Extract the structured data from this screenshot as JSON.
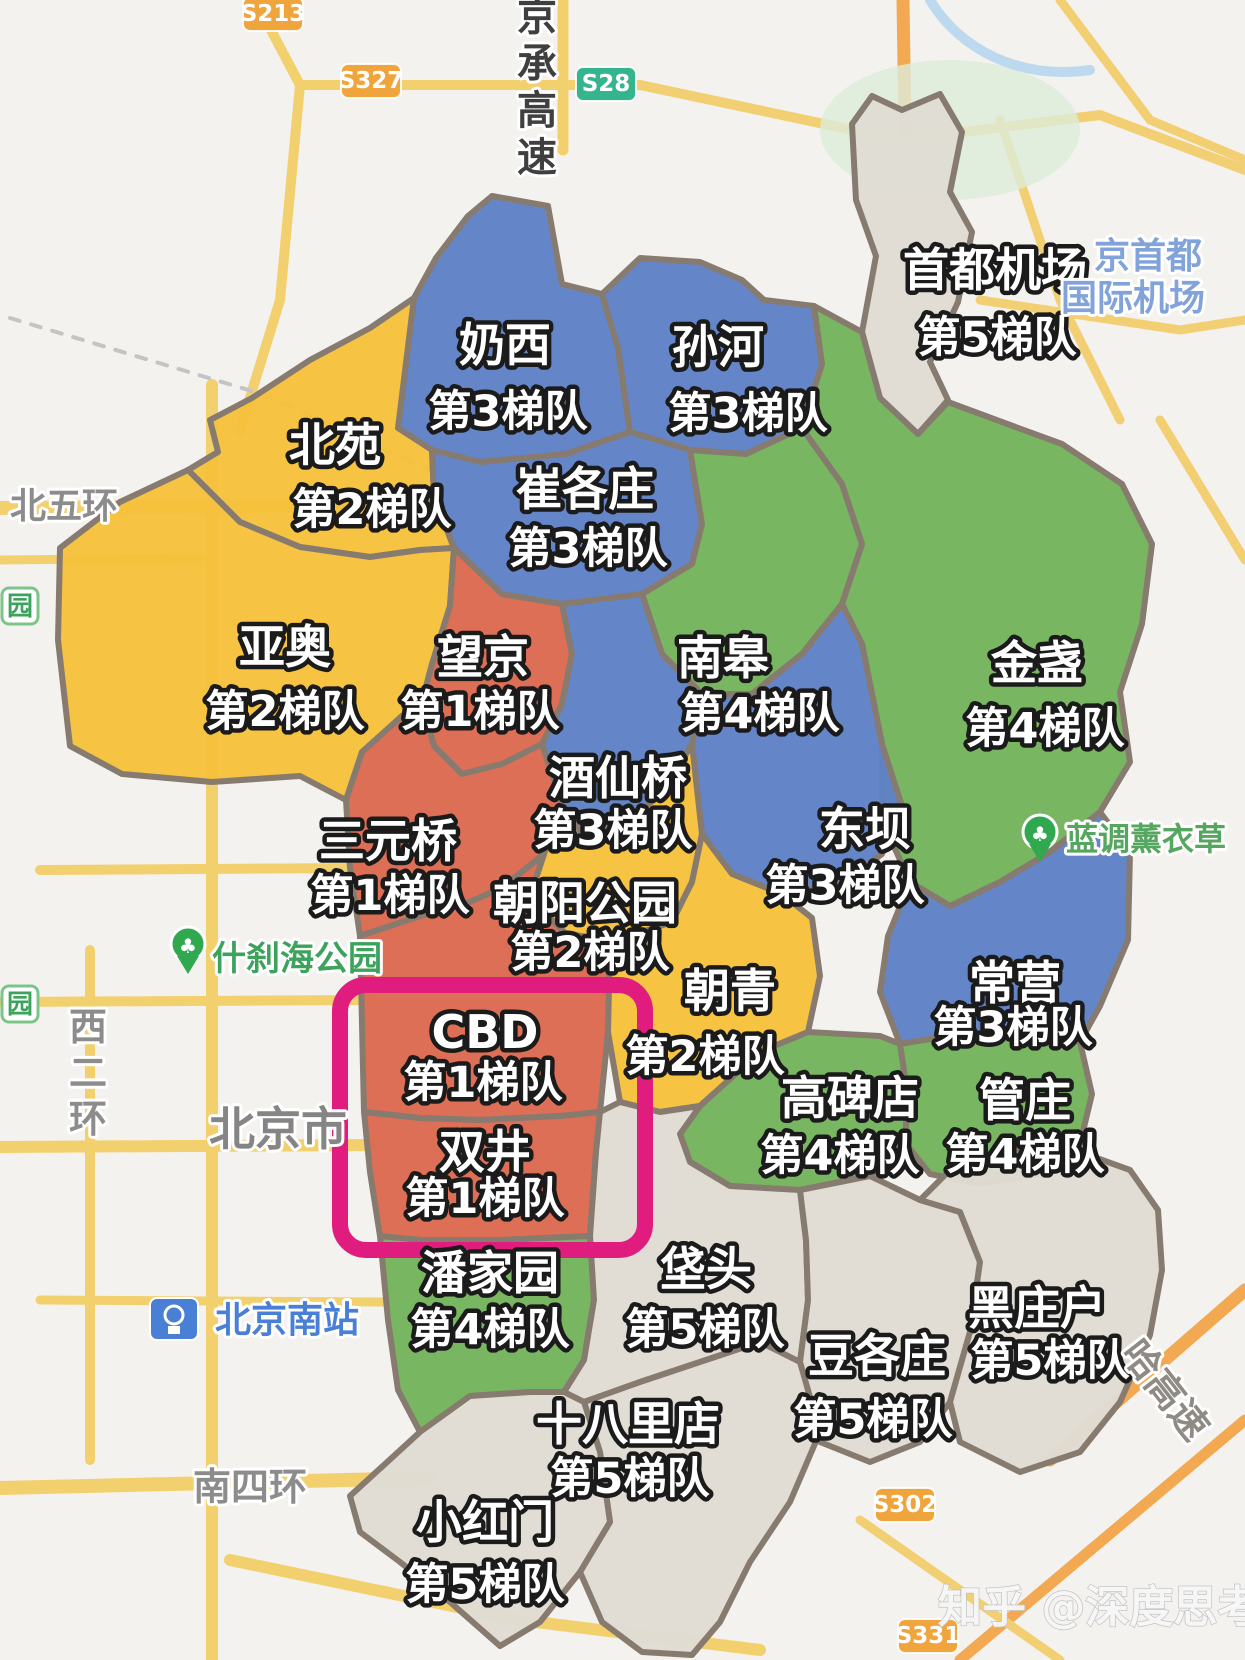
{
  "map": {
    "background_color": "#f4f2ef",
    "border_color": "#877b70",
    "tier_colors": {
      "tier1": "#dc6a51",
      "tier2": "#f6c13c",
      "tier3": "#5f81c5",
      "tier4": "#74b45d",
      "tier5": "#e0dcd4"
    },
    "highlight_box": {
      "x": 340,
      "y": 985,
      "w": 305,
      "h": 265,
      "color": "#e01c7f",
      "stroke_width": 16,
      "radius": 26,
      "regions": "CBD / 双井"
    },
    "watermark": "知乎 @深度思考",
    "regions": [
      {
        "id": "naixi",
        "name": "奶西",
        "tier": "第3梯队",
        "tier_num": 3,
        "color": "#5f81c5",
        "polygon": "398,428 414,298 436,258 468,216 492,196 548,206 562,284 602,294 618,348 630,432 566,454 480,462 432,450",
        "label": {
          "name_x": 505,
          "name_y": 345,
          "tier_x": 508,
          "tier_y": 412
        }
      },
      {
        "id": "sunhe",
        "name": "孙河",
        "tier": "第3梯队",
        "tier_num": 3,
        "color": "#5f81c5",
        "polygon": "602,294 640,258 700,262 742,280 764,300 814,306 822,364 802,428 746,454 690,450 630,432 618,348",
        "label": {
          "name_x": 718,
          "name_y": 347,
          "tier_x": 748,
          "tier_y": 414
        }
      },
      {
        "id": "shoudujichang",
        "name": "首都机场",
        "tier": "第5梯队",
        "tier_num": 5,
        "color": "#e0dcd4",
        "polygon": "852,124 872,96 902,110 940,94 962,132 950,192 972,232 958,302 930,362 948,400 918,434 880,398 862,332 876,256 856,200",
        "label": {
          "name_x": 995,
          "name_y": 270,
          "tier_x": 997,
          "tier_y": 338
        }
      },
      {
        "id": "beiyuan",
        "name": "北苑",
        "tier": "第2梯队",
        "tier_num": 2,
        "color": "#f6c13c",
        "polygon": "188,470 218,452 210,420 252,398 310,360 370,328 414,298 398,428 432,450 434,496 454,548 420,550 370,557 300,547 240,522",
        "label": {
          "name_x": 335,
          "name_y": 445,
          "tier_x": 372,
          "tier_y": 510
        }
      },
      {
        "id": "cuigezhuang",
        "name": "崔各庄",
        "tier": "第3梯队",
        "tier_num": 3,
        "color": "#5f81c5",
        "polygon": "432,450 480,462 566,454 630,432 690,450 702,524 692,564 642,594 562,604 502,594 454,548 434,496",
        "label": {
          "name_x": 585,
          "name_y": 489,
          "tier_x": 588,
          "tier_y": 549
        }
      },
      {
        "id": "yaao",
        "name": "亚奥",
        "tier": "第2梯队",
        "tier_num": 2,
        "color": "#f6c13c",
        "polygon": "188,470 240,522 300,547 370,557 420,550 454,548 450,606 432,664 422,702 402,716 362,752 346,800 300,776 212,782 122,774 70,746 58,640 60,548 120,502",
        "label": {
          "name_x": 285,
          "name_y": 647,
          "tier_x": 285,
          "tier_y": 712
        }
      },
      {
        "id": "wangjing",
        "name": "望京",
        "tier": "第1梯队",
        "tier_num": 1,
        "color": "#dc6a51",
        "polygon": "454,548 502,594 562,604 572,654 562,704 542,744 502,764 462,774 434,746 422,702 432,664 450,606",
        "label": {
          "name_x": 483,
          "name_y": 657,
          "tier_x": 480,
          "tier_y": 712
        }
      },
      {
        "id": "nangao",
        "name": "南皋",
        "tier": "第4梯队",
        "tier_num": 4,
        "color": "#74b45d",
        "polygon": "690,450 746,454 802,428 842,484 862,544 842,604 802,654 752,694 702,694 662,654 642,594 692,564 702,524",
        "label": {
          "name_x": 723,
          "name_y": 658,
          "tier_x": 760,
          "tier_y": 714
        }
      },
      {
        "id": "jinzhan",
        "name": "金盏",
        "tier": "第4梯队",
        "tier_num": 4,
        "color": "#74b45d",
        "polygon": "802,428 822,364 814,306 862,332 880,398 918,434 948,402 1002,422 1062,444 1122,484 1152,544 1142,624 1120,692 1130,762 1100,812 1050,852 1000,882 950,906 910,882 882,820 882,744 862,644 842,604 862,544 842,484",
        "label": {
          "name_x": 1037,
          "name_y": 663,
          "tier_x": 1045,
          "tier_y": 729
        }
      },
      {
        "id": "jiuxianqiao",
        "name": "酒仙桥",
        "tier": "第3梯队",
        "tier_num": 3,
        "color": "#5f81c5",
        "polygon": "562,604 642,594 662,654 702,694 692,744 662,794 622,824 582,834 562,804 542,744 562,704 572,654",
        "label": {
          "name_x": 618,
          "name_y": 778,
          "tier_x": 613,
          "tier_y": 831
        }
      },
      {
        "id": "dongba",
        "name": "东坝",
        "tier": "第3梯队",
        "tier_num": 3,
        "color": "#5f81c5",
        "polygon": "702,694 752,694 802,654 842,604 862,644 882,744 902,806 882,854 842,884 782,894 732,874 702,834 692,744",
        "label": {
          "name_x": 865,
          "name_y": 829,
          "tier_x": 845,
          "tier_y": 886
        }
      },
      {
        "id": "sanyuanqiao",
        "name": "三元桥",
        "tier": "第1梯队",
        "tier_num": 1,
        "color": "#dc6a51",
        "polygon": "346,800 362,752 402,716 422,702 434,746 462,774 502,764 542,744 562,804 544,854 502,888 460,906 420,916 360,936 350,868",
        "label": {
          "name_x": 388,
          "name_y": 841,
          "tier_x": 390,
          "tier_y": 896
        }
      },
      {
        "id": "chaoyanggongyuan",
        "name": "朝阳公园",
        "tier": "第2梯队",
        "tier_num": 2,
        "color": "#f6c13c",
        "polygon": "562,804 582,834 622,824 662,794 692,744 702,834 692,882 672,922 642,932 610,940 566,934 546,914 534,884 544,854",
        "label": {
          "name_x": 585,
          "name_y": 903,
          "tier_x": 590,
          "tier_y": 953
        }
      },
      {
        "id": "cbd",
        "name": "CBD",
        "tier": "第1梯队",
        "tier_num": 1,
        "color": "#dc6a51",
        "polygon": "360,936 420,916 460,906 502,888 544,854 534,884 546,914 566,934 610,940 608,1032 600,1112 560,1116 480,1120 420,1118 364,1112",
        "label": {
          "name_x": 485,
          "name_y": 1032,
          "tier_x": 483,
          "tier_y": 1083
        }
      },
      {
        "id": "shuangjing",
        "name": "双井",
        "tier": "第1梯队",
        "tier_num": 1,
        "color": "#dc6a51",
        "polygon": "364,1112 420,1118 480,1120 560,1116 600,1112 596,1152 590,1236 500,1240 420,1240 380,1236 370,1172",
        "label": {
          "name_x": 485,
          "name_y": 1152,
          "tier_x": 485,
          "tier_y": 1199
        }
      },
      {
        "id": "chaoqing",
        "name": "朝青",
        "tier": "第2梯队",
        "tier_num": 2,
        "color": "#f6c13c",
        "polygon": "610,940 642,932 672,922 692,882 702,834 732,874 782,894 812,918 820,976 808,1032 760,1052 700,1106 660,1112 620,1102 608,1032",
        "label": {
          "name_x": 730,
          "name_y": 991,
          "tier_x": 705,
          "tier_y": 1057
        }
      },
      {
        "id": "changying",
        "name": "常营",
        "tier": "第3梯队",
        "tier_num": 3,
        "color": "#5f81c5",
        "polygon": "910,882 950,906 1000,882 1050,852 1100,812 1130,852 1128,940 1100,1006 1080,1042 1020,1034 960,1034 900,1044 880,992 888,936",
        "label": {
          "name_x": 1015,
          "name_y": 983,
          "tier_x": 1013,
          "tier_y": 1028
        }
      },
      {
        "id": "gaobeidian",
        "name": "高碑店",
        "tier": "第4梯队",
        "tier_num": 4,
        "color": "#74b45d",
        "polygon": "700,1106 760,1052 808,1032 880,1036 900,1044 906,1084 906,1144 870,1176 800,1190 730,1186 690,1162 680,1134",
        "label": {
          "name_x": 850,
          "name_y": 1098,
          "tier_x": 840,
          "tier_y": 1156
        }
      },
      {
        "id": "guanzhuang",
        "name": "管庄",
        "tier": "第4梯队",
        "tier_num": 4,
        "color": "#74b45d",
        "polygon": "900,1044 960,1034 1020,1034 1080,1042 1092,1094 1080,1144 1038,1174 980,1184 930,1174 906,1144 906,1084",
        "label": {
          "name_x": 1025,
          "name_y": 1100,
          "tier_x": 1025,
          "tier_y": 1155
        }
      },
      {
        "id": "panjiayuan",
        "name": "潘家园",
        "tier": "第4梯队",
        "tier_num": 4,
        "color": "#74b45d",
        "polygon": "380,1236 420,1240 500,1240 590,1236 594,1300 584,1360 564,1392 530,1392 470,1396 420,1432 398,1390 388,1320",
        "label": {
          "name_x": 490,
          "name_y": 1273,
          "tier_x": 490,
          "tier_y": 1330
        }
      },
      {
        "id": "fatou",
        "name": "垡头",
        "tier": "第5梯队",
        "tier_num": 5,
        "color": "#e0dcd4",
        "polygon": "590,1236 596,1152 600,1112 620,1102 660,1112 700,1106 680,1134 690,1162 730,1186 800,1190 806,1240 808,1300 800,1362 760,1342 700,1362 640,1382 584,1402 564,1392 584,1360 594,1300",
        "label": {
          "name_x": 706,
          "name_y": 1269,
          "tier_x": 705,
          "tier_y": 1330
        }
      },
      {
        "id": "dougezhuang",
        "name": "豆各庄",
        "tier": "第5梯队",
        "tier_num": 5,
        "color": "#e0dcd4",
        "polygon": "800,1190 870,1176 920,1200 960,1212 980,1262 970,1332 950,1402 920,1442 870,1462 820,1442 800,1362 808,1300 806,1240",
        "label": {
          "name_x": 877,
          "name_y": 1356,
          "tier_x": 873,
          "tier_y": 1420
        }
      },
      {
        "id": "heizhuanghu",
        "name": "黑庄户",
        "tier": "第5梯队",
        "tier_num": 5,
        "color": "#e0dcd4",
        "polygon": "920,1200 960,1160 1020,1150 1080,1152 1130,1170 1158,1210 1162,1270 1150,1335 1120,1402 1080,1452 1020,1472 960,1442 950,1402 970,1332 980,1262 960,1212",
        "label": {
          "name_x": 1037,
          "name_y": 1308,
          "tier_x": 1050,
          "tier_y": 1361
        }
      },
      {
        "id": "shibalidian",
        "name": "十八里店",
        "tier": "第5梯队",
        "tier_num": 5,
        "color": "#e0dcd4",
        "polygon": "584,1402 640,1382 700,1362 760,1342 800,1362 820,1432 790,1502 750,1562 720,1622 692,1655 642,1652 602,1622 580,1572 610,1522 600,1452",
        "label": {
          "name_x": 628,
          "name_y": 1424,
          "tier_x": 630,
          "tier_y": 1479
        }
      },
      {
        "id": "xiaohongmen",
        "name": "小红门",
        "tier": "第5梯队",
        "tier_num": 5,
        "color": "#e0dcd4",
        "polygon": "350,1496 420,1432 470,1396 530,1392 564,1392 584,1402 600,1452 610,1522 580,1572 540,1622 500,1646 450,1602 400,1562 360,1532",
        "label": {
          "name_x": 485,
          "name_y": 1522,
          "tier_x": 485,
          "tier_y": 1585
        }
      }
    ],
    "map_labels": [
      {
        "id": "jingcheng-expwy",
        "text": "京承高速",
        "x": 537,
        "y": 30,
        "size": 40,
        "color": "#3f3f3f",
        "type": "vtext",
        "dy": 47
      },
      {
        "id": "xierhuan",
        "text": "西二环",
        "x": 88,
        "y": 1040,
        "size": 38,
        "color": "#8c8c8c",
        "type": "vtext",
        "dy": 46
      },
      {
        "id": "beiwuhuan",
        "text": "北五环",
        "x": 10,
        "y": 518,
        "size": 36,
        "color": "#8c8c8c",
        "type": "text",
        "anchor": "start"
      },
      {
        "id": "beijingshi",
        "text": "北京市",
        "x": 278,
        "y": 1145,
        "size": 46,
        "color": "#858585",
        "type": "text",
        "anchor": "middle"
      },
      {
        "id": "nansihuan",
        "text": "南四环",
        "x": 250,
        "y": 1500,
        "size": 38,
        "color": "#8c8c8c",
        "type": "text",
        "anchor": "middle"
      },
      {
        "id": "beijingnanzhan",
        "text": "北京南站",
        "x": 215,
        "y": 1332,
        "size": 36,
        "color": "#4a7fd6",
        "type": "text",
        "anchor": "start"
      },
      {
        "id": "shichahai-park",
        "text": "什刹海公园",
        "x": 212,
        "y": 970,
        "size": 34,
        "color": "#3da25c",
        "type": "text",
        "anchor": "start"
      },
      {
        "id": "landiao-lavender",
        "text": "蓝调薰衣草",
        "x": 1066,
        "y": 850,
        "size": 32,
        "color": "#55a65f",
        "type": "text",
        "anchor": "start"
      },
      {
        "id": "jingshoudu",
        "text": "京首都",
        "x": 1148,
        "y": 268,
        "size": 36,
        "color": "#82a3da",
        "type": "text",
        "anchor": "middle"
      },
      {
        "id": "guojijichang",
        "text": "国际机场",
        "x": 1133,
        "y": 310,
        "size": 36,
        "color": "#82a3da",
        "type": "text",
        "anchor": "middle"
      },
      {
        "id": "jingha-expwy",
        "text": "哈高速",
        "x": 1155,
        "y": 1398,
        "size": 38,
        "color": "#8f8a84",
        "type": "text",
        "anchor": "middle",
        "rotate": 52
      },
      {
        "id": "park-badge-1",
        "text": "园",
        "x": 2,
        "y": 588,
        "size": 26,
        "color": "#3da25c",
        "type": "park-badge"
      },
      {
        "id": "park-badge-2",
        "text": "园",
        "x": 2,
        "y": 986,
        "size": 26,
        "color": "#3da25c",
        "type": "park-badge"
      }
    ],
    "road_badges": [
      {
        "id": "s213",
        "text": "S213",
        "x": 273,
        "y": 14,
        "fill": "#f0a43c"
      },
      {
        "id": "s327",
        "text": "S327",
        "x": 371,
        "y": 81,
        "fill": "#f0a43c"
      },
      {
        "id": "s28",
        "text": "S28",
        "x": 606,
        "y": 84,
        "fill": "#35b58e"
      },
      {
        "id": "s302",
        "text": "S302",
        "x": 905,
        "y": 1505,
        "fill": "#f0a43c"
      },
      {
        "id": "s331",
        "text": "S331",
        "x": 928,
        "y": 1636,
        "fill": "#f0a43c"
      }
    ]
  }
}
